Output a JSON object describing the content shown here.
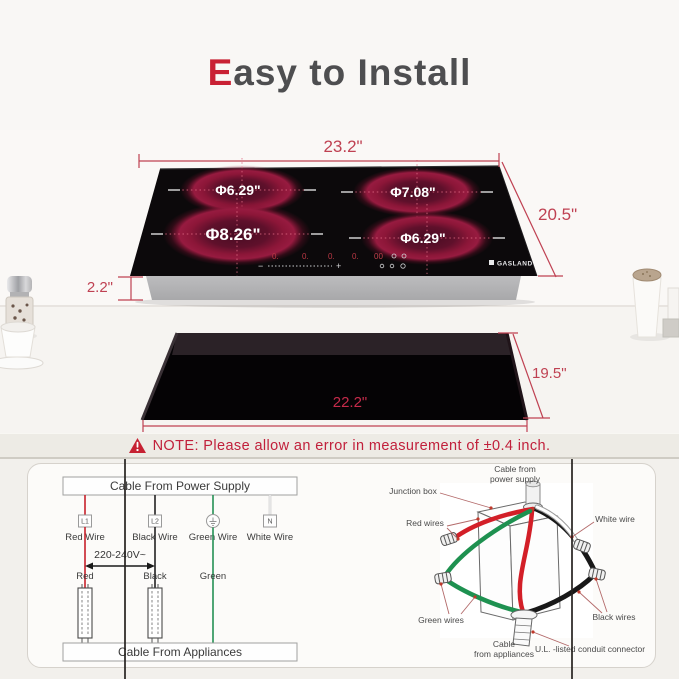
{
  "title": {
    "accent": "E",
    "rest": "asy to Install"
  },
  "cooktop": {
    "brand": "GASLAND",
    "burners": [
      {
        "id": "top-left",
        "label": "Φ6.29\""
      },
      {
        "id": "top-right",
        "label": "Φ7.08\""
      },
      {
        "id": "bottom-left",
        "label": "Φ8.26\""
      },
      {
        "id": "bottom-right",
        "label": "Φ6.29\""
      }
    ],
    "control": {
      "zone_displays": [
        "0.",
        "0.",
        "0.",
        "0."
      ],
      "timer_display": "00",
      "slider_minus": "−",
      "slider_plus": "+"
    }
  },
  "dimensions": {
    "cooktop_width": "23.2\"",
    "cooktop_depth": "20.5\"",
    "cooktop_height": "2.2\"",
    "cutout_width": "22.2\"",
    "cutout_depth": "19.5\""
  },
  "note": {
    "text": "NOTE: Please allow an error in measurement of ±0.4 inch."
  },
  "wiring_diagram": {
    "power_label": "Cable From Power Supply",
    "appliance_label": "Cable From Appliances",
    "voltage": "220-240V~",
    "wires": [
      {
        "terminal": "L1",
        "name": "Red Wire",
        "tag": "Red"
      },
      {
        "terminal": "L2",
        "name": "Black Wire",
        "tag": "Black"
      },
      {
        "terminal": "",
        "name": "Green Wire",
        "tag": "Green"
      },
      {
        "terminal": "N",
        "name": "White Wire",
        "tag": ""
      }
    ]
  },
  "junction_diagram": {
    "labels": {
      "power_1": "Cable from",
      "power_2": "power supply",
      "junction_box": "Junction box",
      "red_wires": "Red wires",
      "white_wire": "White wire",
      "green_wires": "Green wires",
      "black_wires": "Black wires",
      "appliance_1": "Cable",
      "appliance_2": "from appliances",
      "connector": "U.L. -listed conduit connector"
    }
  },
  "colors": {
    "accent_red": "#c92134",
    "dimension_red": "#bf4152",
    "note_red": "#c1203b",
    "wire_red": "#c8202a",
    "wire_green": "#269156",
    "burner_ring": "#8c1738"
  }
}
